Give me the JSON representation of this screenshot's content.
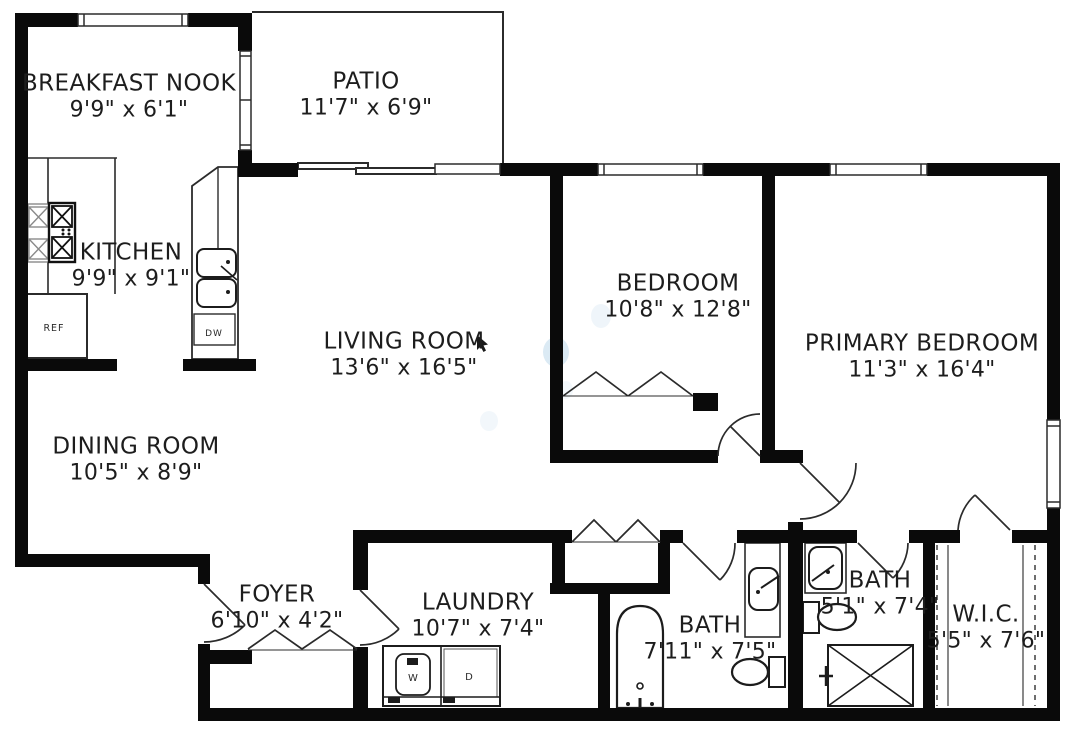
{
  "plan": {
    "type": "residential-floor-plan",
    "colors": {
      "wall": "#0a0a0a",
      "line": "#2b2b2b",
      "text": "#1d1d1d",
      "background": "#ffffff",
      "watermark_blue": "#7fb2d9"
    },
    "rooms": {
      "breakfast_nook": {
        "name": "BREAKFAST NOOK",
        "dims": "9'9\" x 6'1\""
      },
      "patio": {
        "name": "PATIO",
        "dims": "11'7\" x 6'9\""
      },
      "kitchen": {
        "name": "KITCHEN",
        "dims": "9'9\" x 9'1\""
      },
      "living_room": {
        "name": "LIVING ROOM",
        "dims": "13'6\" x 16'5\""
      },
      "bedroom": {
        "name": "BEDROOM",
        "dims": "10'8\" x 12'8\""
      },
      "primary_bedroom": {
        "name": "PRIMARY BEDROOM",
        "dims": "11'3\" x 16'4\""
      },
      "dining_room": {
        "name": "DINING ROOM",
        "dims": "10'5\" x 8'9\""
      },
      "foyer": {
        "name": "FOYER",
        "dims": "6'10\" x 4'2\""
      },
      "laundry": {
        "name": "LAUNDRY",
        "dims": "10'7\" x 7'4\""
      },
      "bath_main": {
        "name": "BATH",
        "dims": "7'11\" x 7'5\""
      },
      "bath_ensuite": {
        "name": "BATH",
        "dims": "5'1\" x 7'4\""
      },
      "walk_in_closet": {
        "name": "W.I.C.",
        "dims": "5'5\" x 7'6\""
      }
    },
    "appliances": {
      "refrigerator": "REF",
      "dishwasher": "DW",
      "washer": "W",
      "dryer": "D"
    }
  }
}
